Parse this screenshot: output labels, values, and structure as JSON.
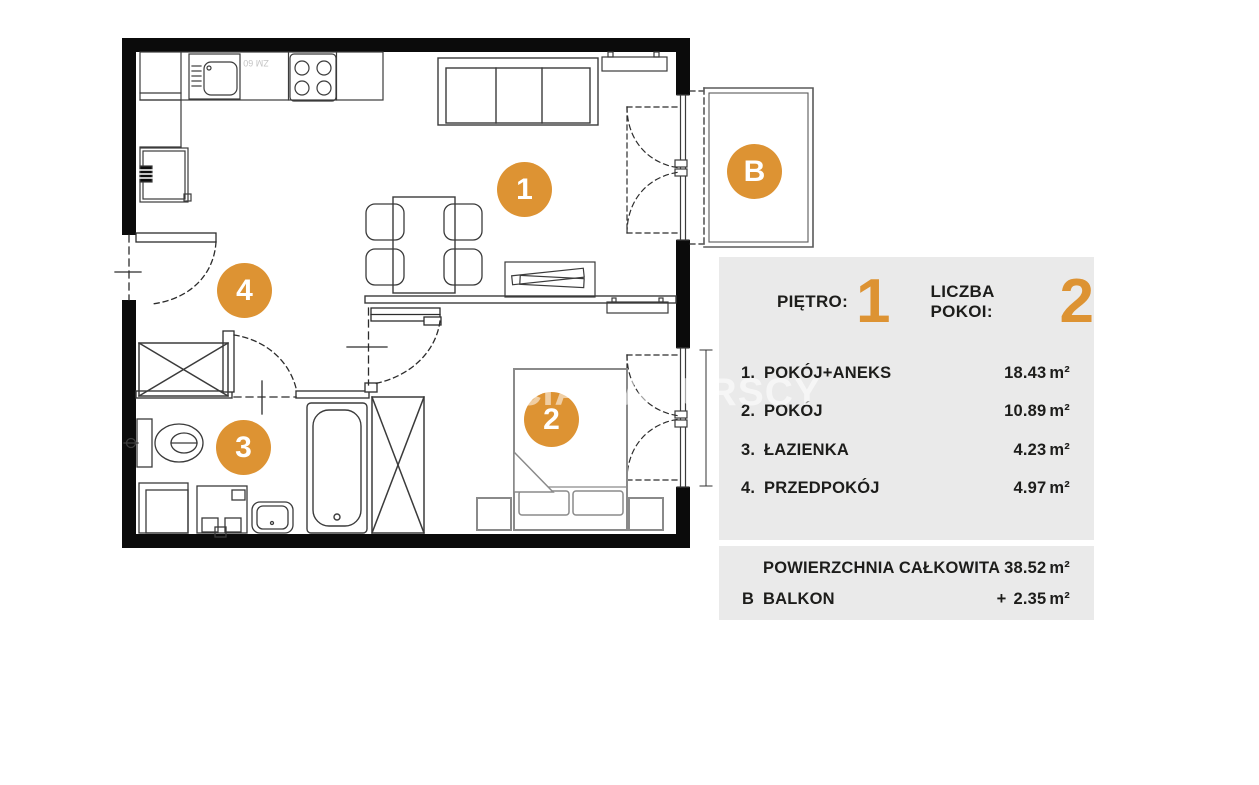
{
  "watermark": {
    "text": "BRACIA SADURSCY"
  },
  "plan": {
    "dishwasher_label": "ZM 60",
    "markers": [
      {
        "label": "1",
        "room": "pokoj-aneks"
      },
      {
        "label": "2",
        "room": "pokoj"
      },
      {
        "label": "3",
        "room": "lazienka"
      },
      {
        "label": "4",
        "room": "przedpokoj"
      },
      {
        "label": "B",
        "room": "balkon"
      }
    ]
  },
  "panel": {
    "floor": {
      "label": "PIĘTRO:",
      "value": "1"
    },
    "rooms_count": {
      "label": "LICZBA POKOI:",
      "value": "2"
    },
    "rooms": [
      {
        "no": "1.",
        "name": "POKÓJ+ANEKS",
        "area": "18.43",
        "unit": "m²"
      },
      {
        "no": "2.",
        "name": "POKÓJ",
        "area": "10.89",
        "unit": "m²"
      },
      {
        "no": "3.",
        "name": "ŁAZIENKA",
        "area": "4.23",
        "unit": "m²"
      },
      {
        "no": "4.",
        "name": "PRZEDPOKÓJ",
        "area": "4.97",
        "unit": "m²"
      }
    ],
    "summary": [
      {
        "no": "",
        "name": "POWIERZCHNIA CAŁKOWITA",
        "prefix": "",
        "area": "38.52",
        "unit": "m²"
      },
      {
        "no": "B",
        "name": "BALKON",
        "prefix": "+",
        "area": "2.35",
        "unit": "m²"
      }
    ]
  },
  "colors": {
    "accent": "#DD9333",
    "panel_bg": "#EAEAEA",
    "wall": "#0b0b0b",
    "text": "#1D1D1B"
  }
}
